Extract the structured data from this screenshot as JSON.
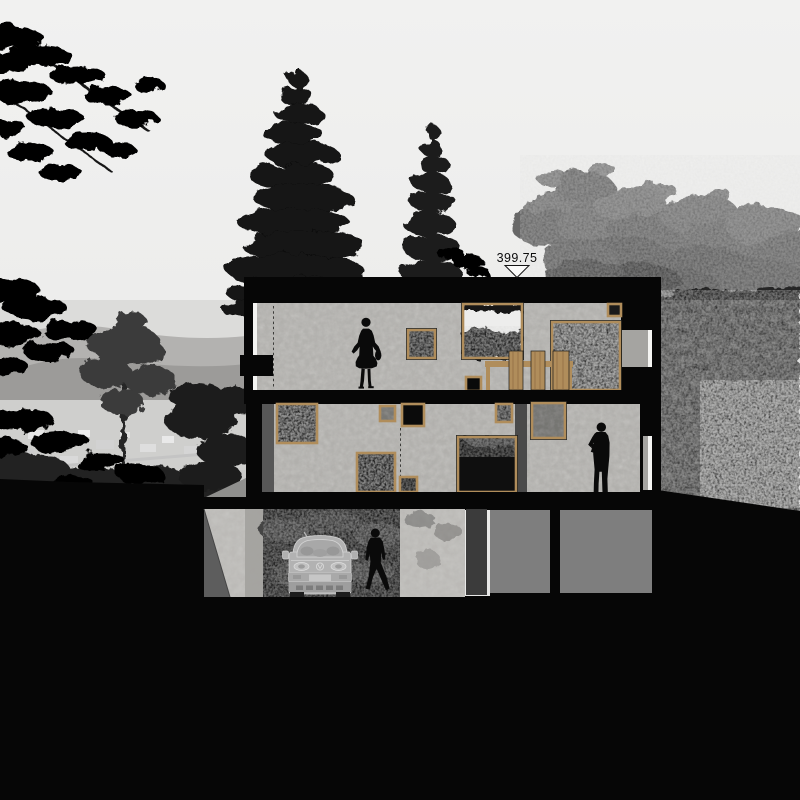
{
  "elevation_marker": {
    "value": "399.75"
  },
  "colors": {
    "sky": "#ededec",
    "ink": "#060606",
    "concrete": "#c6c5c2",
    "concrete-dark": "#a5a4a1",
    "wood": "#b08d5b",
    "panel-gray": "#7e7e7e",
    "panel-dark": "#3b3b3b",
    "van-gray": "#b2b2b2",
    "tree-gray": "#6d6d6d",
    "white-strip": "#f4f4f2"
  },
  "figures": {
    "upper_floor": "standing-woman-silhouette",
    "middle_floor": "standing-man-silhouette",
    "garage": "walking-man-silhouette",
    "vehicle": "van-front-outline"
  }
}
